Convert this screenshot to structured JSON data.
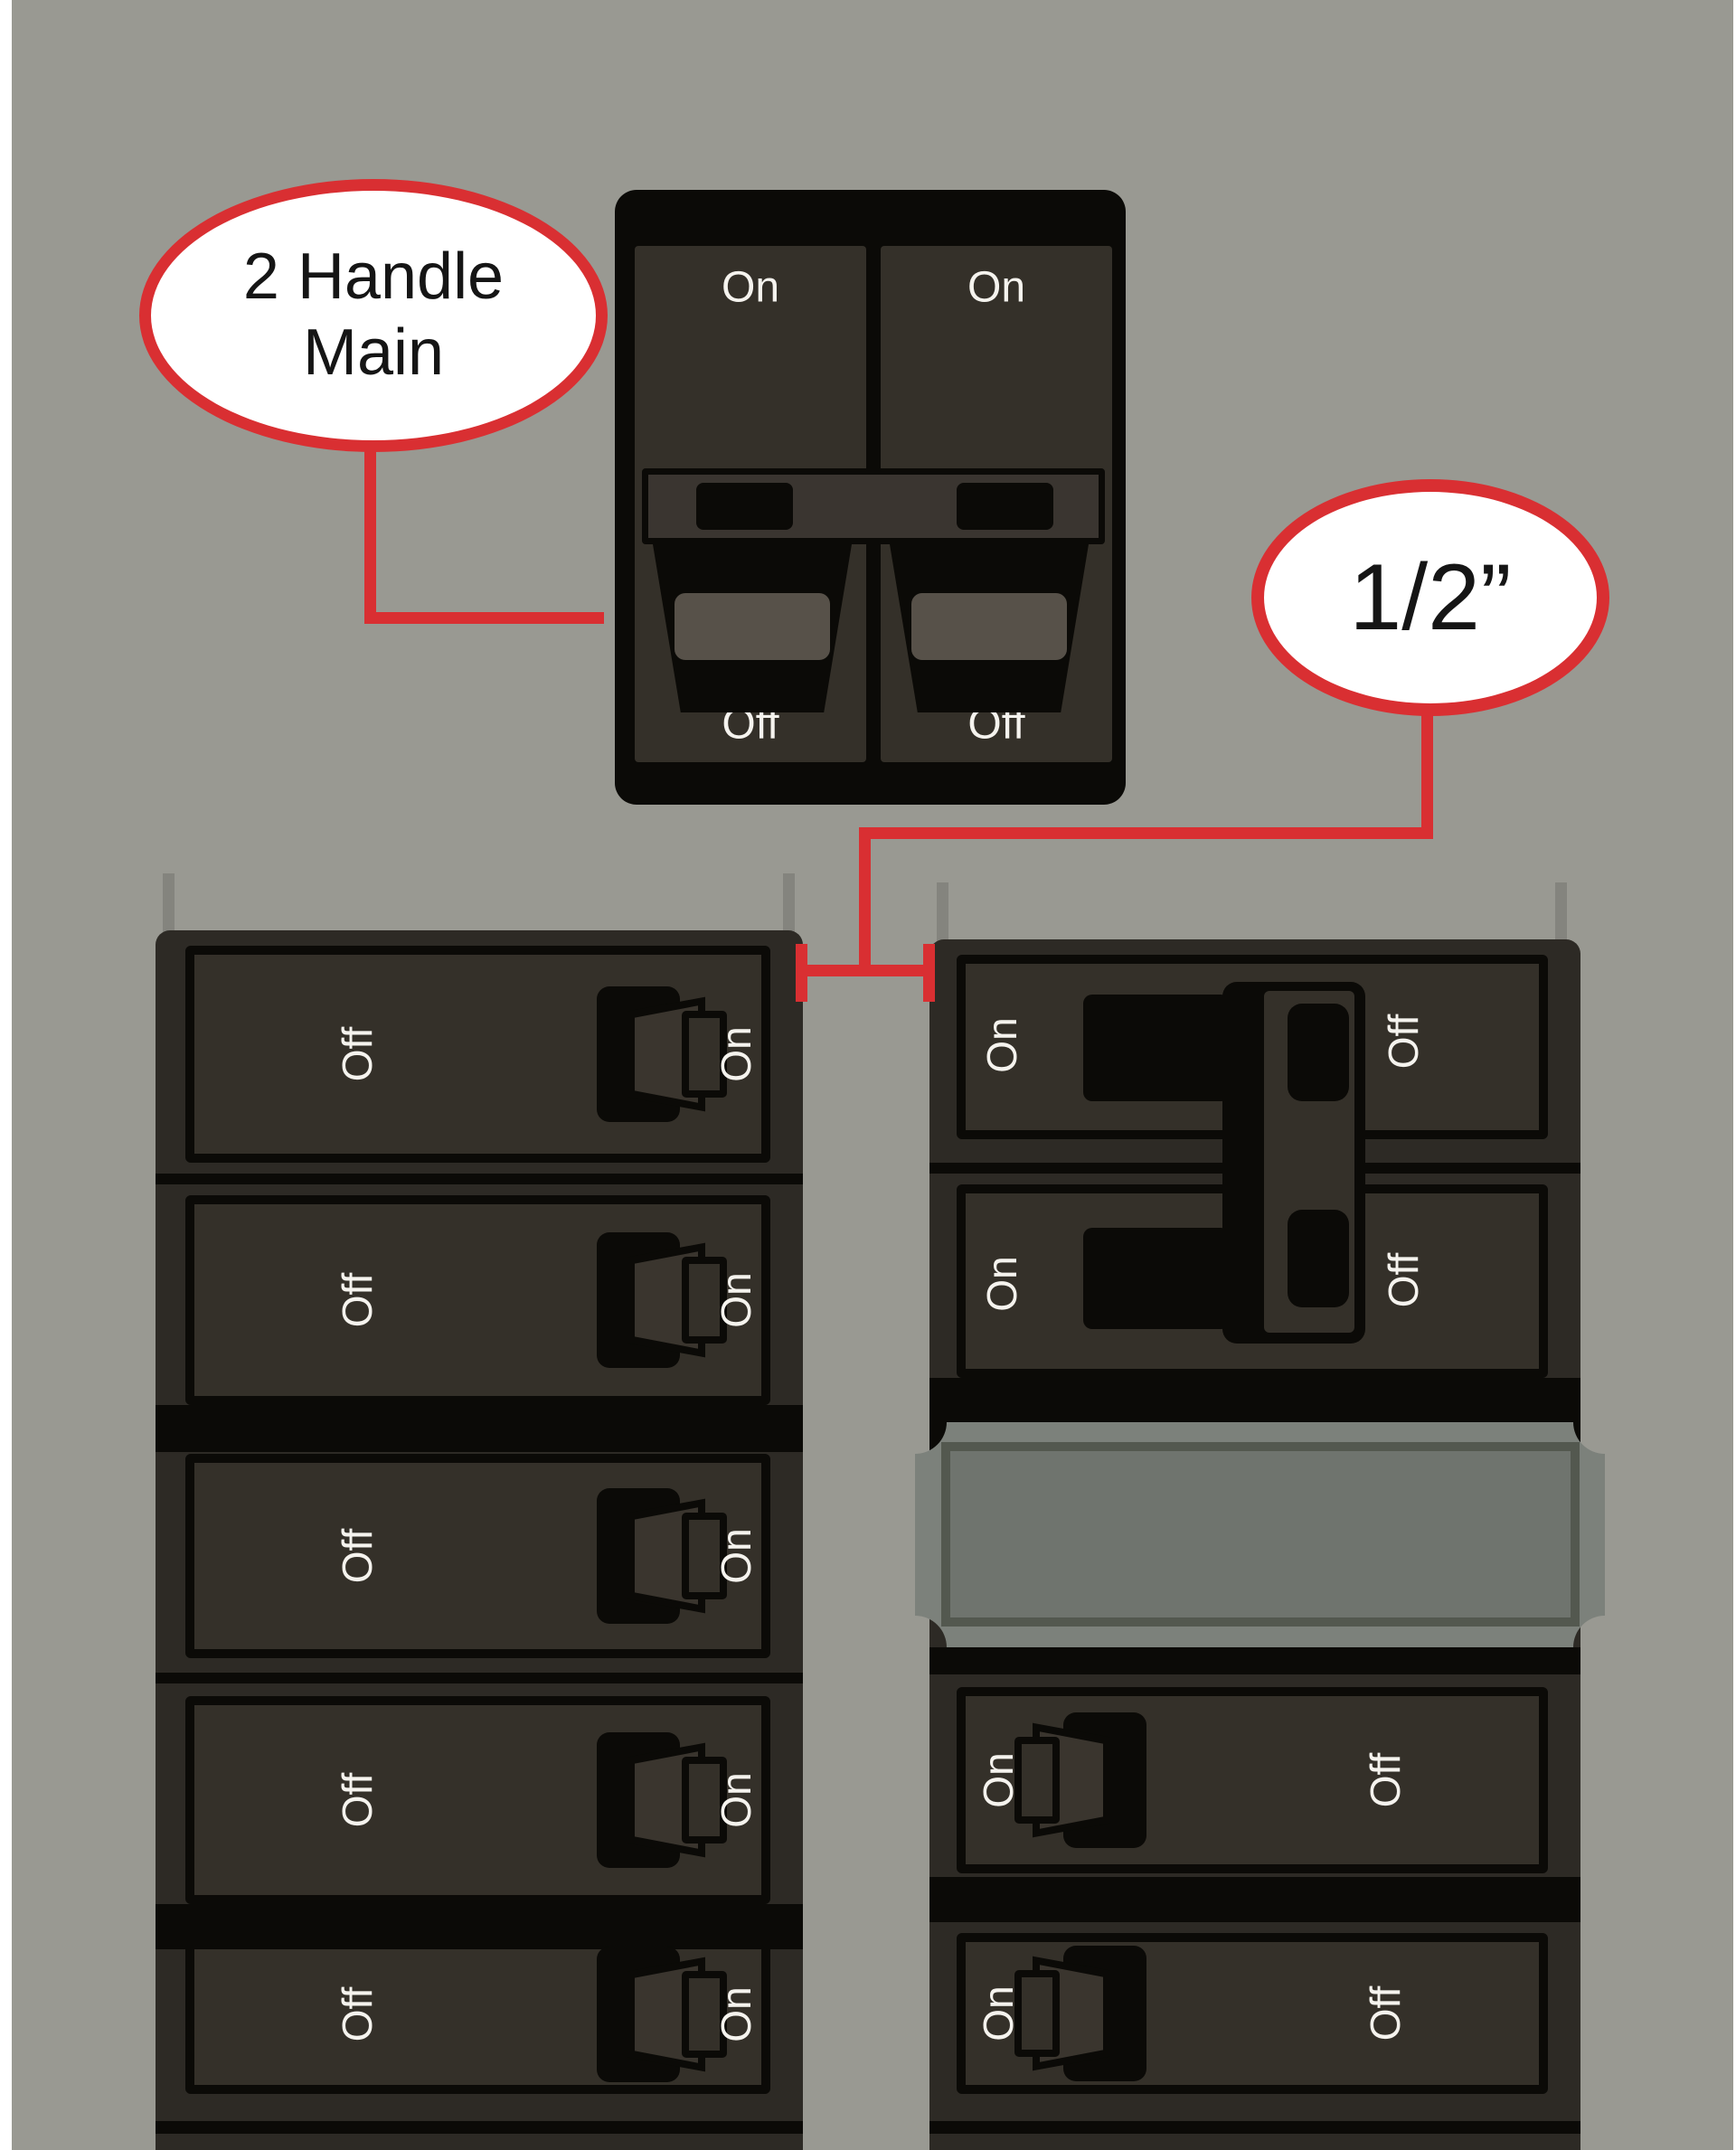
{
  "background_color": "#999992",
  "accent_red": "#d92f32",
  "shell_color": "#2d2a25",
  "panel_color": "#343029",
  "blank_plate_color": "#7c817b",
  "callouts": {
    "main": {
      "line1": "2 Handle",
      "line2": "Main"
    },
    "gap": {
      "label": "1/2”"
    }
  },
  "main_breaker": {
    "poles": [
      {
        "on_label": "On",
        "off_label": "Off"
      },
      {
        "on_label": "On",
        "off_label": "Off"
      }
    ]
  },
  "left_column": {
    "breakers": [
      {
        "off_label": "Off",
        "on_label": "On"
      },
      {
        "off_label": "Off",
        "on_label": "On"
      },
      {
        "off_label": "Off",
        "on_label": "On"
      },
      {
        "off_label": "Off",
        "on_label": "On"
      },
      {
        "off_label": "Off",
        "on_label": "On"
      }
    ]
  },
  "right_column": {
    "double_breaker": {
      "rows": [
        {
          "on_label": "On",
          "off_label": "Off"
        },
        {
          "on_label": "On",
          "off_label": "Off"
        }
      ]
    },
    "singles": [
      {
        "on_label": "On",
        "off_label": "Off"
      },
      {
        "on_label": "On",
        "off_label": "Off"
      }
    ]
  }
}
